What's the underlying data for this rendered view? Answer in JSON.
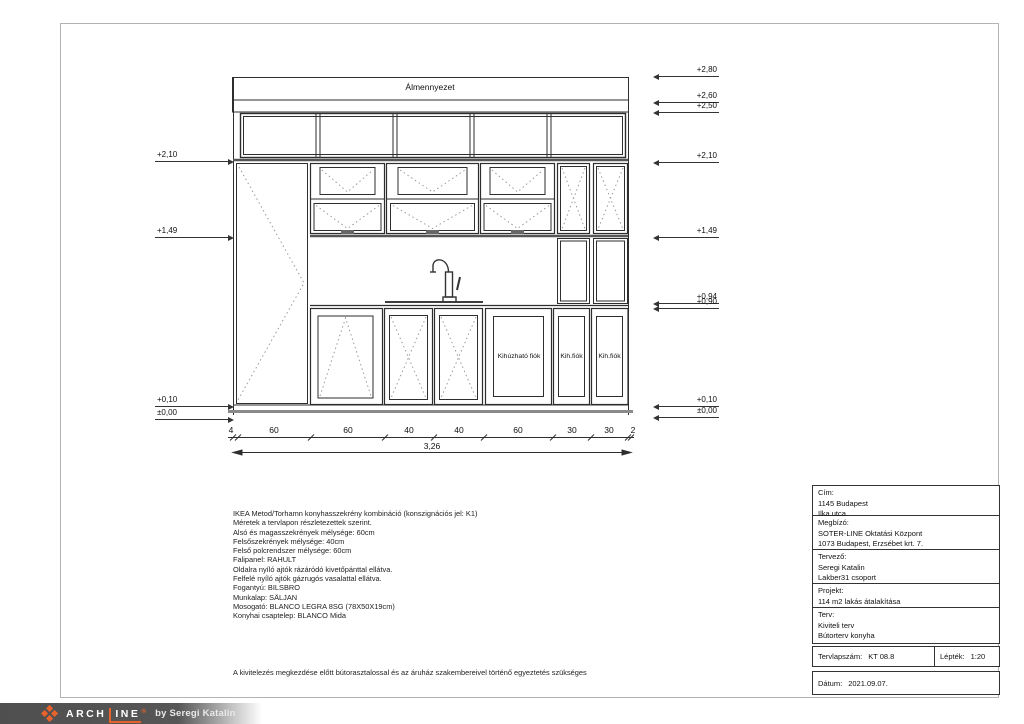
{
  "drawing": {
    "ceiling_label": "Álmennyezet",
    "drawer_labels": [
      "Kihúzható fiók",
      "Kih.fiók",
      "Kih.fiók"
    ],
    "levels_left": [
      "+2,10",
      "+1,49",
      "+0,10",
      "±0,00"
    ],
    "levels_right": [
      "+2,80",
      "+2,60",
      "+2,50",
      "+2,10",
      "+1,49",
      "+0,94",
      "+0,90",
      "+0,10",
      "±0,00"
    ],
    "dim_segments": [
      "4",
      "60",
      "60",
      "40",
      "40",
      "60",
      "30",
      "30",
      "2"
    ],
    "dim_total": "3,26"
  },
  "notes": {
    "lines": [
      "IKEA Metod/Torhamn konyhasszekrény kombináció (konszignációs jel: K1)",
      "Méretek a tervlapon részletezettek szerint.",
      "Alsó és magasszekrények mélysége: 60cm",
      "Felsőszekrények mélysége: 40cm",
      "Felső polcrendszer mélysége: 60cm",
      "Falipanel: RAHULT",
      "Oldalra nyíló ajtók rázáródó kivetőpánttal ellátva.",
      "Felfelé nyíló ajtók gázrugós vasalattal ellátva.",
      "Fogantyú: BILSBRO",
      "Munkalap: SÄLJAN",
      "Mosogató: BLANCO LEGRA 8SG (78X50X19cm)",
      "Konyhai csaptelep: BLANCO Mida"
    ],
    "footnote": "A kivitelezés megkezdése előtt bútorasztalossal és az áruház szakembereivel történő egyeztetés szükséges"
  },
  "title_block": {
    "rows": [
      {
        "label": "Cím:",
        "lines": [
          "1145 Budapest",
          "Ilka utca"
        ]
      },
      {
        "label": "Megbízó:",
        "lines": [
          "SOTER-LINE Oktatási Központ",
          "1073 Budapest, Erzsébet krt. 7."
        ]
      },
      {
        "label": "Tervező:",
        "lines": [
          "Seregi Katalin",
          "Lakber31 csoport"
        ]
      },
      {
        "label": "Projekt:",
        "lines": [
          "114 m2 lakás átalakítása"
        ]
      },
      {
        "label": "Terv:",
        "lines": [
          "Kiviteli terv",
          "Bútorterv konyha"
        ]
      }
    ],
    "sheet_number_label": "Tervlapszám:",
    "sheet_number": "KT 08.8",
    "scale_label": "Lépték:",
    "scale": "1:20",
    "date_label": "Dátum:",
    "date": "2021.09.07."
  },
  "footer": {
    "brand_prefix": "ARCH",
    "brand_suffix": "INE",
    "brand_mark": "®",
    "byline": "by Seregi Katalin",
    "accent_color": "#e8622d"
  }
}
